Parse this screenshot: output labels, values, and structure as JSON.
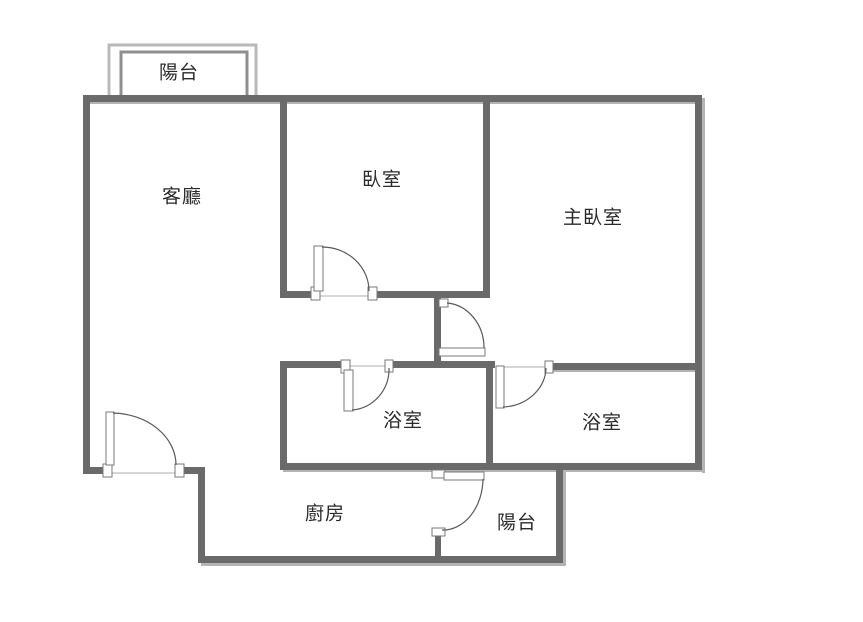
{
  "title": "apartment-floor-plan",
  "colors": {
    "background": "#ffffff",
    "wall": "#6a6a6a",
    "wall_shadow": "#b4b4b4",
    "balcony_outer": "#b9b9b9",
    "balcony_inner": "#8f8f8f",
    "door_fill": "#ffffff",
    "door_stroke": "#787878",
    "arc_stroke": "#5a5a5a",
    "threshold": "#c9c9c9",
    "text": "#2a2a2a"
  },
  "rooms": [
    {
      "id": "balcony-top",
      "label": "陽台",
      "cx": 179,
      "cy": 71
    },
    {
      "id": "living-room",
      "label": "客廳",
      "cx": 182,
      "cy": 195
    },
    {
      "id": "bedroom",
      "label": "臥室",
      "cx": 382,
      "cy": 178
    },
    {
      "id": "master-bedroom",
      "label": "主臥室",
      "cx": 593,
      "cy": 216
    },
    {
      "id": "bathroom-left",
      "label": "浴室",
      "cx": 403,
      "cy": 419
    },
    {
      "id": "bathroom-right",
      "label": "浴室",
      "cx": 602,
      "cy": 421
    },
    {
      "id": "kitchen",
      "label": "廚房",
      "cx": 325,
      "cy": 512
    },
    {
      "id": "balcony-bottom",
      "label": "陽台",
      "cx": 517,
      "cy": 521
    }
  ],
  "floorplan": {
    "canvas": {
      "width": 863,
      "height": 622
    },
    "walls": [
      {
        "name": "wall-top",
        "x": 85,
        "y": 95,
        "w": 617,
        "h": 7
      },
      {
        "name": "wall-left",
        "x": 83,
        "y": 95,
        "w": 7,
        "h": 379
      },
      {
        "name": "wall-right",
        "x": 695,
        "y": 95,
        "w": 7,
        "h": 375
      },
      {
        "name": "wall-entry-left",
        "x": 83,
        "y": 467,
        "w": 27,
        "h": 7
      },
      {
        "name": "wall-entry-right",
        "x": 176,
        "y": 467,
        "w": 29,
        "h": 7
      },
      {
        "name": "wall-kitchen-left",
        "x": 198,
        "y": 469,
        "w": 7,
        "h": 94
      },
      {
        "name": "wall-bottom",
        "x": 198,
        "y": 556,
        "w": 365,
        "h": 7
      },
      {
        "name": "wall-balcony-right",
        "x": 556,
        "y": 466,
        "w": 7,
        "h": 97
      },
      {
        "name": "wall-living-bedroom",
        "x": 280,
        "y": 95,
        "w": 7,
        "h": 203
      },
      {
        "name": "wall-bedroom-bottom-left",
        "x": 280,
        "y": 291,
        "w": 33,
        "h": 7
      },
      {
        "name": "wall-bedroom-bottom-right",
        "x": 375,
        "y": 291,
        "w": 115,
        "h": 7
      },
      {
        "name": "wall-bedroom-master",
        "x": 483,
        "y": 95,
        "w": 7,
        "h": 203
      },
      {
        "name": "wall-corridor-stub",
        "x": 434,
        "y": 298,
        "w": 7,
        "h": 67
      },
      {
        "name": "wall-bath-top-left",
        "x": 280,
        "y": 361,
        "w": 70,
        "h": 7
      },
      {
        "name": "wall-bath-top-mid",
        "x": 387,
        "y": 361,
        "w": 108,
        "h": 7
      },
      {
        "name": "wall-bath-left",
        "x": 280,
        "y": 361,
        "w": 7,
        "h": 109
      },
      {
        "name": "wall-bath-divider",
        "x": 486,
        "y": 361,
        "w": 7,
        "h": 106
      },
      {
        "name": "wall-master-bottom",
        "x": 550,
        "y": 363,
        "w": 152,
        "h": 7
      },
      {
        "name": "wall-baths-bottom",
        "x": 280,
        "y": 463,
        "w": 422,
        "h": 7
      },
      {
        "name": "wall-balcony-door-stub",
        "x": 435,
        "y": 534,
        "w": 6,
        "h": 24
      }
    ],
    "shadows": [
      {
        "name": "shadow-top",
        "x": 88,
        "y": 102,
        "w": 614,
        "h": 2
      },
      {
        "name": "shadow-right",
        "x": 702,
        "y": 98,
        "w": 3,
        "h": 375
      },
      {
        "name": "shadow-bottom",
        "x": 201,
        "y": 563,
        "w": 365,
        "h": 3
      },
      {
        "name": "shadow-balcony-right",
        "x": 563,
        "y": 469,
        "w": 3,
        "h": 97
      },
      {
        "name": "shadow-baths-bottom",
        "x": 283,
        "y": 470,
        "w": 422,
        "h": 2
      },
      {
        "name": "shadow-master-bottom",
        "x": 553,
        "y": 370,
        "w": 149,
        "h": 2
      }
    ],
    "balcony_outline": {
      "outer": "109,100 109,45 256,45 256,100",
      "inner": "121,100 121,52 247,52 247,100"
    },
    "thresholds": [
      {
        "name": "threshold-bedroom-door",
        "x1": 320,
        "y1": 296,
        "x2": 368,
        "y2": 296
      },
      {
        "name": "threshold-entry-door",
        "x1": 111,
        "y1": 473,
        "x2": 175,
        "y2": 473
      },
      {
        "name": "threshold-bath-left-door",
        "x1": 350,
        "y1": 366,
        "x2": 385,
        "y2": 366
      },
      {
        "name": "threshold-bath-right-door",
        "x1": 504,
        "y1": 367,
        "x2": 545,
        "y2": 367
      }
    ],
    "door_jambs": [
      {
        "name": "jamb-bedroom-left",
        "x": 311,
        "y": 287,
        "w": 9,
        "h": 13
      },
      {
        "name": "jamb-bedroom-right",
        "x": 368,
        "y": 287,
        "w": 9,
        "h": 13
      },
      {
        "name": "jamb-corridor-top",
        "x": 439,
        "y": 299,
        "w": 9,
        "h": 8
      },
      {
        "name": "jamb-bath-left-a",
        "x": 341,
        "y": 360,
        "w": 9,
        "h": 13
      },
      {
        "name": "jamb-bath-left-b",
        "x": 385,
        "y": 360,
        "w": 8,
        "h": 12
      },
      {
        "name": "jamb-bath-right",
        "x": 545,
        "y": 361,
        "w": 8,
        "h": 12
      },
      {
        "name": "jamb-entry-left",
        "x": 103,
        "y": 464,
        "w": 9,
        "h": 13
      },
      {
        "name": "jamb-entry-right",
        "x": 175,
        "y": 464,
        "w": 9,
        "h": 13
      },
      {
        "name": "jamb-balcony-door-top",
        "x": 432,
        "y": 470,
        "w": 13,
        "h": 8
      },
      {
        "name": "jamb-balcony-door-bottom",
        "x": 432,
        "y": 528,
        "w": 13,
        "h": 8
      }
    ],
    "door_leaves": [
      {
        "name": "leaf-bedroom-door",
        "x": 314,
        "y": 246,
        "w": 9,
        "h": 45
      },
      {
        "name": "leaf-corridor-door",
        "x": 439,
        "y": 348,
        "w": 46,
        "h": 8
      },
      {
        "name": "leaf-bath-left-door",
        "x": 344,
        "y": 370,
        "w": 9,
        "h": 41
      },
      {
        "name": "leaf-bath-right-door",
        "x": 496,
        "y": 366,
        "w": 8,
        "h": 42
      },
      {
        "name": "leaf-entry-door",
        "x": 106,
        "y": 412,
        "w": 8,
        "h": 53
      },
      {
        "name": "leaf-balcony-door",
        "x": 444,
        "y": 472,
        "w": 40,
        "h": 8
      }
    ],
    "door_arcs": [
      {
        "name": "arc-bedroom-door",
        "d": "M 322 247 A 47 44 0 0 1 369 291"
      },
      {
        "name": "arc-corridor-door",
        "d": "M 447 303 A 40 45 0 0 1 484 348"
      },
      {
        "name": "arc-bath-left-door",
        "d": "M 352 410 A 40 41 0 0 0 389 368"
      },
      {
        "name": "arc-bath-right-door",
        "d": "M 503 407 A 45 40 0 0 0 546 368"
      },
      {
        "name": "arc-entry-door",
        "d": "M 113 413 A 65 52 0 0 1 176 465"
      },
      {
        "name": "arc-balcony-door",
        "d": "M 483 479 A 40 52 0 0 1 442 530"
      }
    ]
  }
}
